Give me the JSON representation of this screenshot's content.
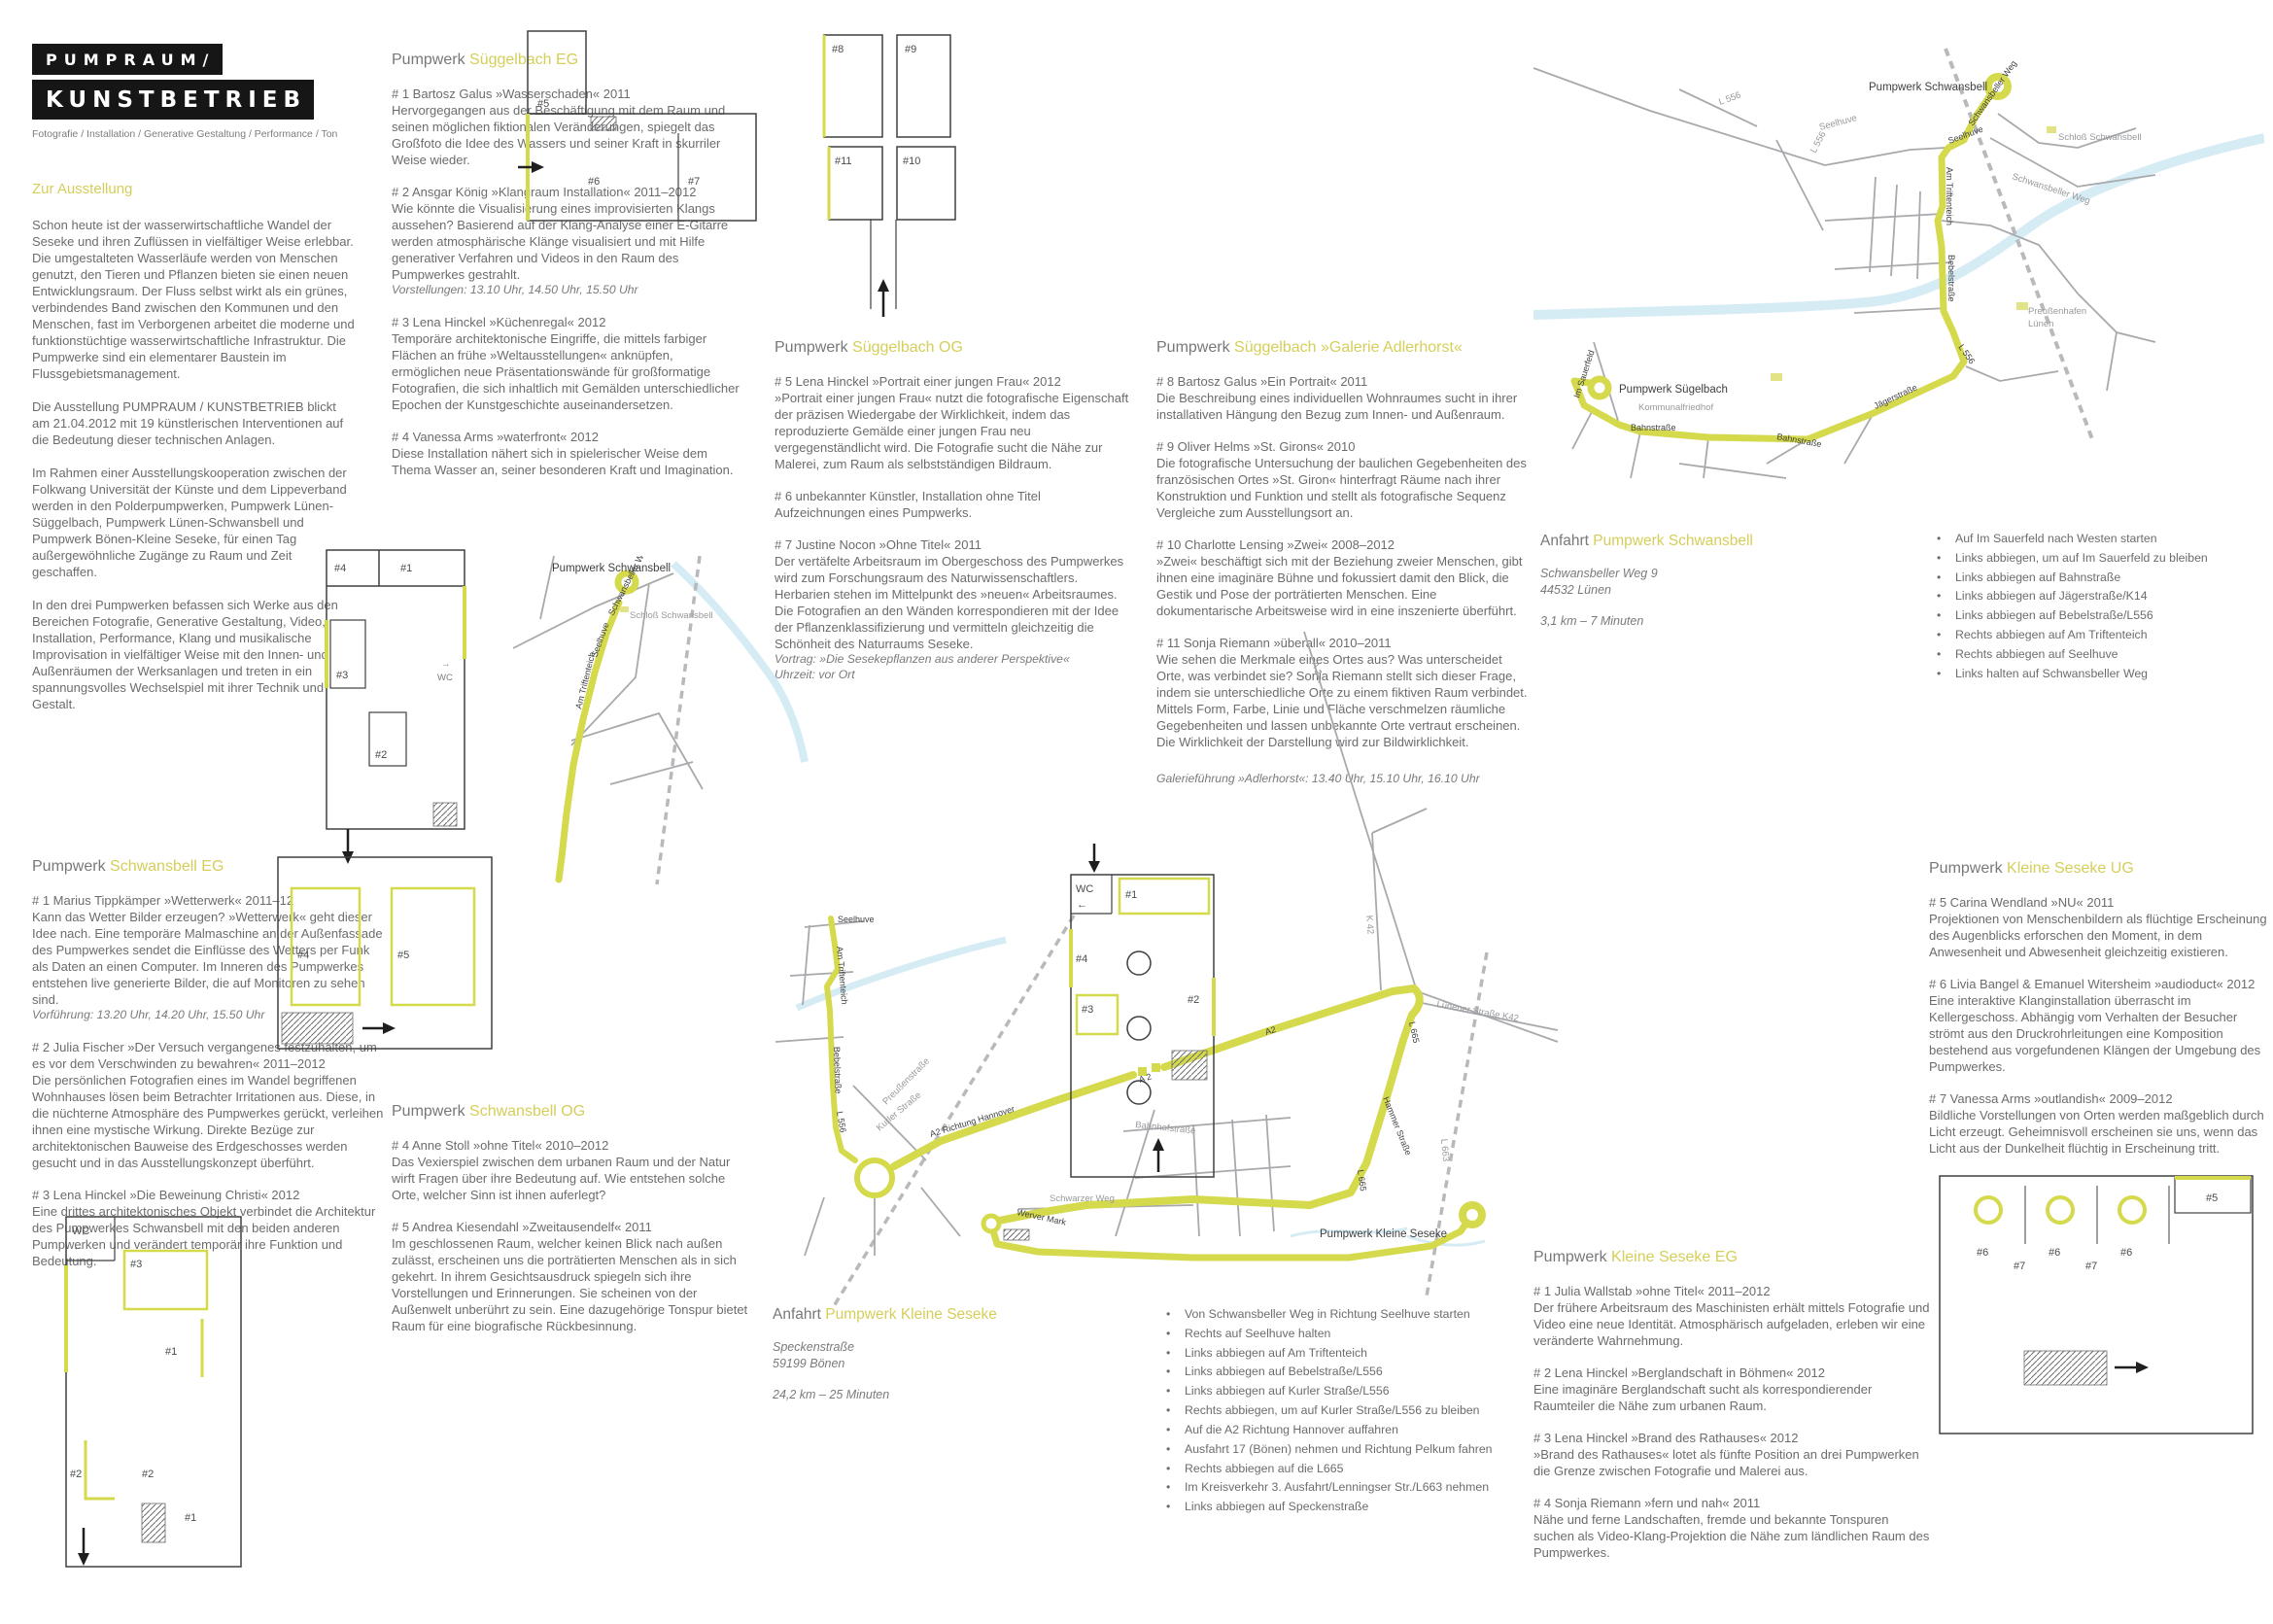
{
  "colors": {
    "accent": "#d5ce5a",
    "route": "#d5d94c",
    "text": "#6b6c6e",
    "river": "#d6ecf4",
    "road": "#a7a9ac",
    "logo_bg": "#161616"
  },
  "logo": {
    "line1": "PUMPRAUM/",
    "line2": "KUNSTBETRIEB",
    "subtitle": "Fotografie / Installation / Generative Gestaltung / Performance / Ton"
  },
  "intro": {
    "heading": "Zur Ausstellung",
    "paragraphs": [
      "Schon heute ist der wasserwirtschaftliche Wandel der Seseke und ihren Zuflüssen in vielfältiger Weise erlebbar. Die umgestalteten Wasserläufe werden von Menschen genutzt, den Tieren und Pflanzen bieten sie einen neuen Entwicklungsraum. Der Fluss selbst wirkt als ein grünes, verbindendes Band zwischen den Kommunen und den Menschen, fast im Verborgenen arbeitet die moderne und funktionstüchtige wasserwirtschaftliche Infrastruktur. Die Pumpwerke sind ein elementarer Baustein im Flussgebietsmanagement.",
      "Die Ausstellung PUMPRAUM / KUNSTBETRIEB blickt am 21.04.2012 mit 19 künstlerischen Interventionen auf die Bedeutung dieser technischen Anlagen.",
      "Im Rahmen einer Ausstellungskooperation zwischen der Folkwang Universität der Künste und dem Lippeverband werden in den Polderpumpwerken, Pumpwerk Lünen-Süggelbach, Pumpwerk Lünen-Schwansbell und Pumpwerk Bönen-Kleine Seseke, für einen Tag außergewöhnliche Zugänge zu Raum und Zeit geschaffen.",
      "In den drei Pumpwerken befassen sich Werke aus den Bereichen Fotografie, Generative Gestaltung, Video, Installation, Performance, Klang und musikalische Improvisation in vielfältiger Weise mit den Innen- und Außenräumen der Werksanlagen und treten in ein spannungsvolles Wechselspiel mit ihrer Technik und Gestalt."
    ]
  },
  "sections": {
    "sueggelbach_eg": {
      "prefix": "Pumpwerk",
      "accent": "Süggelbach EG",
      "entries": [
        {
          "title": "# 1 Bartosz Galus »Wasserschaden« 2011",
          "body": "Hervorgegangen aus der Beschäftigung mit dem Raum und seinen möglichen fiktionalen Veränderungen, spiegelt das Großfoto die Idee des Wassers und seiner Kraft in skurriler Weise wieder."
        },
        {
          "title": "# 2 Ansgar König »Klangraum Installation« 2011–2012",
          "body": "Wie könnte die Visualisierung eines improvisierten Klangs aussehen? Basierend auf der Klang-Analyse einer E-Gitarre werden atmosphärische Klänge visualisiert und mit Hilfe generativer Verfahren und Videos in den Raum des Pumpwerkes gestrahlt.",
          "note": "Vorstellungen: 13.10 Uhr, 14.50 Uhr, 15.50 Uhr"
        },
        {
          "title": "# 3 Lena Hinckel »Küchenregal« 2012",
          "body": "Temporäre architektonische Eingriffe, die mittels farbiger Flächen an frühe »Weltausstellungen« anknüpfen, ermöglichen neue Präsentationswände für großformatige Fotografien, die sich inhaltlich mit Gemälden unterschiedlicher Epochen der Kunstgeschichte auseinandersetzen."
        },
        {
          "title": "# 4 Vanessa Arms »waterfront« 2012",
          "body": "Diese Installation nähert sich in spielerischer Weise dem Thema Wasser an, seiner besonderen Kraft und Imagination."
        }
      ]
    },
    "sueggelbach_og": {
      "prefix": "Pumpwerk",
      "accent": "Süggelbach OG",
      "entries": [
        {
          "title": "# 5 Lena Hinckel »Portrait einer jungen Frau« 2012",
          "body": "»Portrait einer jungen Frau« nutzt die fotografische Eigenschaft der präzisen Wiedergabe der Wirklichkeit, indem das reproduzierte Gemälde einer jungen Frau neu vergegenständlicht wird. Die Fotografie sucht die Nähe zur Malerei, zum Raum als selbstständigen Bildraum."
        },
        {
          "title": "# 6 unbekannter Künstler, Installation ohne Titel",
          "body": "Aufzeichnungen eines Pumpwerks."
        },
        {
          "title": "# 7 Justine Nocon »Ohne Titel« 2011",
          "body": "Der vertäfelte Arbeitsraum im Obergeschoss des Pumpwerkes wird zum Forschungsraum des Naturwissenschaftlers. Herbarien stehen im Mittelpunkt des »neuen« Arbeitsraumes. Die Fotografien an den Wänden korrespondieren mit der Idee der Pflanzenklassifizierung und vermitteln gleichzeitig die Schönheit des Naturraums Seseke.",
          "note": "Vortrag: »Die Sesekepflanzen aus anderer Perspektive«",
          "note2": "Uhrzeit: vor Ort"
        }
      ]
    },
    "adlerhorst": {
      "prefix": "Pumpwerk",
      "accent": "Süggelbach »Galerie Adlerhorst«",
      "footer": "Galerieführung »Adlerhorst«: 13.40 Uhr, 15.10 Uhr, 16.10 Uhr",
      "entries": [
        {
          "title": "# 8 Bartosz Galus »Ein Portrait« 2011",
          "body": "Die Beschreibung eines individuellen Wohnraumes sucht in ihrer installativen Hängung den Bezug zum Innen- und Außenraum."
        },
        {
          "title": "# 9 Oliver Helms »St. Girons« 2010",
          "body": "Die fotografische Untersuchung der baulichen Gegebenheiten des französischen Ortes »St. Giron« hinterfragt Räume nach ihrer Konstruktion und Funktion und stellt als fotografische Sequenz Vergleiche zum Ausstellungsort an."
        },
        {
          "title": "# 10 Charlotte Lensing »Zwei« 2008–2012",
          "body": "»Zwei« beschäftigt sich mit der Beziehung zweier Menschen, gibt ihnen eine imaginäre Bühne und fokussiert damit den Blick, die Gestik und Pose der porträtierten Menschen. Eine dokumentarische Arbeitsweise wird in eine inszenierte überführt."
        },
        {
          "title": "# 11 Sonja Riemann »überall« 2010–2011",
          "body": "Wie sehen die Merkmale eines Ortes aus? Was unterscheidet Orte, was verbindet sie? Sonja Riemann stellt sich dieser Frage, indem sie unterschiedliche Orte zu einem fiktiven Raum verbindet. Mittels Form, Farbe, Linie und Fläche verschmelzen räumliche Gegebenheiten und lassen unbekannte Orte vertraut erscheinen. Die Wirklichkeit der Darstellung wird zur Bildwirklichkeit."
        }
      ]
    },
    "schwansbell_eg": {
      "prefix": "Pumpwerk",
      "accent": "Schwansbell EG",
      "entries": [
        {
          "title": "# 1 Marius Tippkämper »Wetterwerk« 2011–12",
          "body": "Kann das Wetter Bilder erzeugen? »Wetterwerk« geht dieser Idee nach. Eine temporäre Malmaschine an der Außenfassade des Pumpwerkes sendet die Einflüsse des Wetters per Funk als Daten an einen Computer. Im Inneren des Pumpwerkes entstehen live generierte Bilder, die auf Monitoren zu sehen sind.",
          "note": "Vorführung: 13.20 Uhr, 14.20 Uhr, 15.50 Uhr"
        },
        {
          "title": "# 2 Julia Fischer »Der Versuch vergangenes festzuhalten, um es vor dem Verschwinden zu bewahren« 2011–2012",
          "body": "Die persönlichen Fotografien eines im Wandel begriffenen Wohnhauses lösen beim Betrachter Irritationen aus. Diese, in die nüchterne Atmosphäre des Pumpwerkes gerückt, verleihen ihnen eine mystische Wirkung. Direkte Bezüge zur architektonischen Bauweise des Erdgeschosses werden gesucht und in das Ausstellungskonzept überführt."
        },
        {
          "title": "# 3 Lena Hinckel »Die Beweinung Christi« 2012",
          "body": "Eine drittes architektonisches Objekt verbindet die Architektur des Pumpwerkes Schwansbell mit den beiden anderen Pumpwerken und verändert temporär ihre Funktion und Bedeutung."
        }
      ]
    },
    "schwansbell_og": {
      "prefix": "Pumpwerk",
      "accent": "Schwansbell OG",
      "entries": [
        {
          "title": "# 4 Anne Stoll »ohne Titel« 2010–2012",
          "body": "Das Vexierspiel zwischen dem urbanen Raum und der Natur wirft Fragen über ihre Bedeutung auf. Wie entstehen solche Orte, welcher Sinn ist ihnen auferlegt?"
        },
        {
          "title": "# 5 Andrea Kiesendahl »Zweitausendelf« 2011",
          "body": "Im geschlossenen Raum, welcher keinen Blick nach außen zulässt, erscheinen uns die porträtierten Menschen als in sich gekehrt. In ihrem Gesichtsausdruck spiegeln sich ihre Vorstellungen und Erinnerungen. Sie scheinen von der Außenwelt unberührt zu sein. Eine dazugehörige Tonspur bietet Raum für eine biografische Rückbesinnung."
        }
      ]
    },
    "seseke_eg": {
      "prefix": "Pumpwerk",
      "accent": "Kleine Seseke EG",
      "entries": [
        {
          "title": "# 1 Julia Wallstab »ohne Titel« 2011–2012",
          "body": "Der frühere Arbeitsraum des Maschinisten erhält mittels Fotografie und Video eine neue Identität. Atmosphärisch aufgeladen, erleben wir eine veränderte Wahrnehmung."
        },
        {
          "title": "# 2 Lena Hinckel »Berglandschaft in Böhmen« 2012",
          "body": "Eine imaginäre Berglandschaft sucht als korrespondierender Raumteiler die Nähe zum urbanen Raum."
        },
        {
          "title": "# 3 Lena Hinckel »Brand des Rathauses« 2012",
          "body": "»Brand des Rathauses« lotet als fünfte Position an drei Pumpwerken die Grenze zwischen Fotografie und Malerei aus."
        },
        {
          "title": "# 4 Sonja Riemann »fern und nah« 2011",
          "body": "Nähe und ferne Landschaften, fremde und bekannte Tonspuren suchen als Video-Klang-Projektion die Nähe zum ländlichen Raum des Pumpwerkes."
        }
      ]
    },
    "seseke_ug": {
      "prefix": "Pumpwerk",
      "accent": "Kleine Seseke UG",
      "entries": [
        {
          "title": "# 5 Carina Wendland »NU« 2011",
          "body": "Projektionen von Menschenbildern als flüchtige Erscheinung des Augenblicks erforschen den Moment, in dem Anwesenheit und Abwesenheit gleichzeitig existieren."
        },
        {
          "title": "# 6 Livia Bangel & Emanuel Witersheim »audioduct« 2012",
          "body": "Eine interaktive Klanginstallation überrascht im Kellergeschoss. Abhängig vom Verhalten der Besucher strömt aus den Druckrohrleitungen eine Komposition bestehend aus vorgefundenen Klängen der Umgebung des Pumpwerkes."
        },
        {
          "title": "# 7 Vanessa Arms »outlandish« 2009–2012",
          "body": "Bildliche Vorstellungen von Orten werden maßgeblich durch Licht erzeugt. Geheimnisvoll erscheinen sie uns, wenn das Licht aus der Dunkelheit flüchtig in Erscheinung tritt."
        }
      ]
    }
  },
  "anfahrt_schwansbell": {
    "prefix": "Anfahrt",
    "accent": "Pumpwerk Schwansbell",
    "address": [
      "Schwansbeller Weg 9",
      "44532 Lünen"
    ],
    "distance": "3,1 km – 7 Minuten",
    "directions": [
      "Auf Im Sauerfeld nach Westen starten",
      "Links abbiegen, um auf Im Sauerfeld zu bleiben",
      "Links abbiegen auf Bahnstraße",
      "Links abbiegen auf Jägerstraße/K14",
      "Links abbiegen auf Bebelstraße/L556",
      "Rechts abbiegen auf Am Triftenteich",
      "Rechts abbiegen auf Seelhuve",
      "Links halten auf Schwansbeller Weg"
    ]
  },
  "anfahrt_seseke": {
    "prefix": "Anfahrt",
    "accent": "Pumpwerk Kleine Seseke",
    "address": [
      "Speckenstraße",
      "59199 Bönen"
    ],
    "distance": "24,2 km – 25 Minuten",
    "directions": [
      "Von Schwansbeller Weg in Richtung Seelhuve starten",
      "Rechts auf Seelhuve halten",
      "Links abbiegen auf Am Triftenteich",
      "Links abbiegen auf Bebelstraße/L556",
      "Links abbiegen auf Kurler Straße/L556",
      "Rechts abbiegen, um auf Kurler Straße/L556 zu bleiben",
      "Auf die A2 Richtung Hannover auffahren",
      "Ausfahrt 17 (Bönen) nehmen und Richtung Pelkum fahren",
      "Rechts abbiegen auf die L665",
      "Im Kreisverkehr 3. Ausfahrt/Lenningser Str./L663 nehmen",
      "Links abbiegen auf Speckenstraße"
    ]
  },
  "maps": {
    "luenen": {
      "pw_schwansbell": "Pumpwerk Schwansbell",
      "schloss": "Schloß Schwansbell",
      "preussenhafen_1": "Preußenhafen",
      "preussenhafen_2": "Lünen",
      "pw_suegelbach": "Pumpwerk Sügelbach",
      "kommunalfriedhof": "Kommunalfriedhof",
      "schwansbeller_weg": "Schwansbeller Weg",
      "seelhuve": "Seelhuve",
      "am_triftenteich": "Am Triftenteich",
      "bebelstrasse": "Bebelstraße",
      "l556": "L 556",
      "jaegerstrasse": "Jägerstraße",
      "bahnstrasse_a": "Bahnstraße",
      "bahnstrasse_b": "Bahnstraße",
      "im_sauerfeld": "Im Sauerfeld",
      "seelhuve_gray": "Seelhuve",
      "schwansbeller_weg_gray": "Sch­wansbeller Weg",
      "l556_gray_a": "L 556",
      "l556_gray_b": "L 556"
    },
    "boenen": {
      "pw_schwansbell": "Pumpwerk Schwansbell",
      "schloss": "Schloß Schwansbell",
      "schwansbeller_weg": "Schwansbeller Weg",
      "seelhuve_a": "Seelhuve",
      "am_triftenteich_a": "Am Triftenteich",
      "seelhuve_b": "Seelhuve",
      "am_triftenteich_b": "Am Triftenteich",
      "bebelstrasse": "Bebelstraße",
      "l556": "L 556",
      "kurler_strasse": "Kurler Straße",
      "preussenstrasse": "Preußenstraße",
      "a2_richtung": "A2  Richtung Hannover",
      "a2_badge": "A 2",
      "a2_small": "A2",
      "a2_gray": "A 2",
      "k42": "K 42",
      "luenener": "Lünener Straße K42",
      "l665_a": "L 665",
      "hammer": "Hammer Straße",
      "l665_b": "L 665",
      "bahnhofstrasse": "Bahnhofstraße",
      "schwarzer_weg": "Schwarzer Weg",
      "werver_mark": "Werver Mark",
      "l663": "L 663",
      "pw_seseke": "Pumpwerk Kleine Seseke"
    }
  },
  "floorplans": {
    "sueggelbach_eg": {
      "r4": "#4",
      "r1": "#1",
      "r3": "#3",
      "r2": "#2",
      "wc_arrow": "→",
      "wc": "WC"
    },
    "sueggelbach_og": {
      "r5": "#5",
      "r6": "#6",
      "r7": "#7"
    },
    "adlerhorst": {
      "r8": "#8",
      "r9": "#9",
      "r11": "#11",
      "r10": "#10"
    },
    "schwansbell_eg": {
      "wc": "WC",
      "wc_arrow": "←",
      "r3": "#3",
      "r1a": "#1",
      "r2a": "#2",
      "r2b": "#2",
      "r1b": "#1"
    },
    "schwansbell_og": {
      "r4": "#4",
      "r5": "#5"
    },
    "seseke_eg": {
      "wc": "WC",
      "wc_arrow": "←",
      "r1": "#1",
      "r4": "#4",
      "r3": "#3",
      "r2": "#2"
    },
    "seseke_ug": {
      "r5": "#5",
      "r6a": "#6",
      "r7a": "#7",
      "r6b": "#6",
      "r7b": "#7",
      "r6c": "#6"
    }
  }
}
